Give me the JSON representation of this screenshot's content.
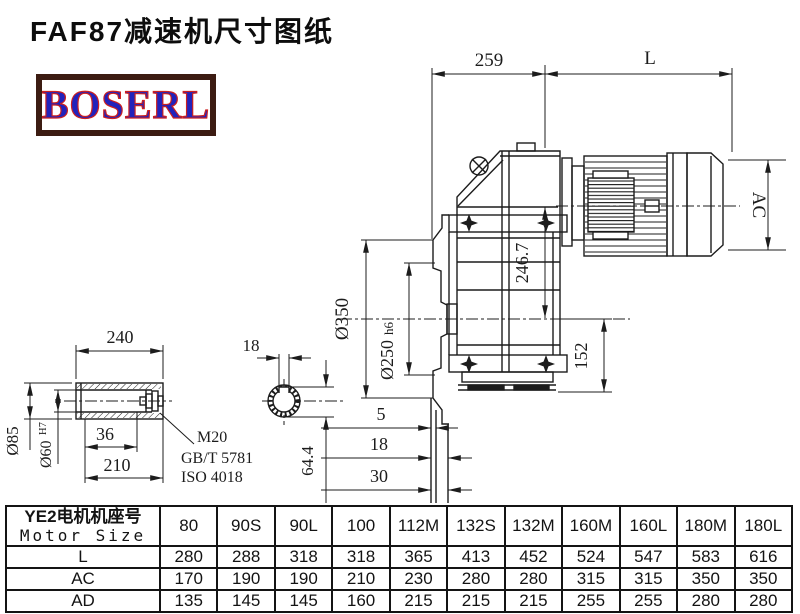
{
  "title": "FAF87减速机尺寸图纸",
  "logo": {
    "text": "BOSERL"
  },
  "drawing": {
    "dims": {
      "gearbox_length": "259",
      "motor_length": "L",
      "motor_diameter": "AC",
      "axis_height": "246.7",
      "flange_diameter": "Ø350",
      "spigot_diameter": "Ø250",
      "spigot_tolerance": "h6",
      "output_height": "152",
      "face_step_1": "5",
      "face_step_2": "18",
      "face_step_3": "30",
      "shaft_length": "240",
      "hub_diameter": "Ø85",
      "bore_diameter": "Ø60",
      "bore_tolerance": "H7",
      "recess_depth": "36",
      "bore_depth": "210",
      "keyway_width": "18",
      "keyway_height": "64.4",
      "thread": "M20",
      "standard_gb": "GB/T 5781",
      "standard_iso": "ISO 4018"
    }
  },
  "table": {
    "header_cn": "YE2电机机座号",
    "header_en": "Motor Size",
    "columns": [
      "80",
      "90S",
      "90L",
      "100",
      "112M",
      "132S",
      "132M",
      "160M",
      "160L",
      "180M",
      "180L"
    ],
    "rows": [
      {
        "label": "L",
        "values": [
          "280",
          "288",
          "318",
          "318",
          "365",
          "413",
          "452",
          "524",
          "547",
          "583",
          "616"
        ]
      },
      {
        "label": "AC",
        "values": [
          "170",
          "190",
          "190",
          "210",
          "230",
          "280",
          "280",
          "315",
          "315",
          "350",
          "350"
        ]
      },
      {
        "label": "AD",
        "values": [
          "135",
          "145",
          "145",
          "160",
          "215",
          "215",
          "215",
          "255",
          "255",
          "280",
          "280"
        ]
      }
    ]
  }
}
